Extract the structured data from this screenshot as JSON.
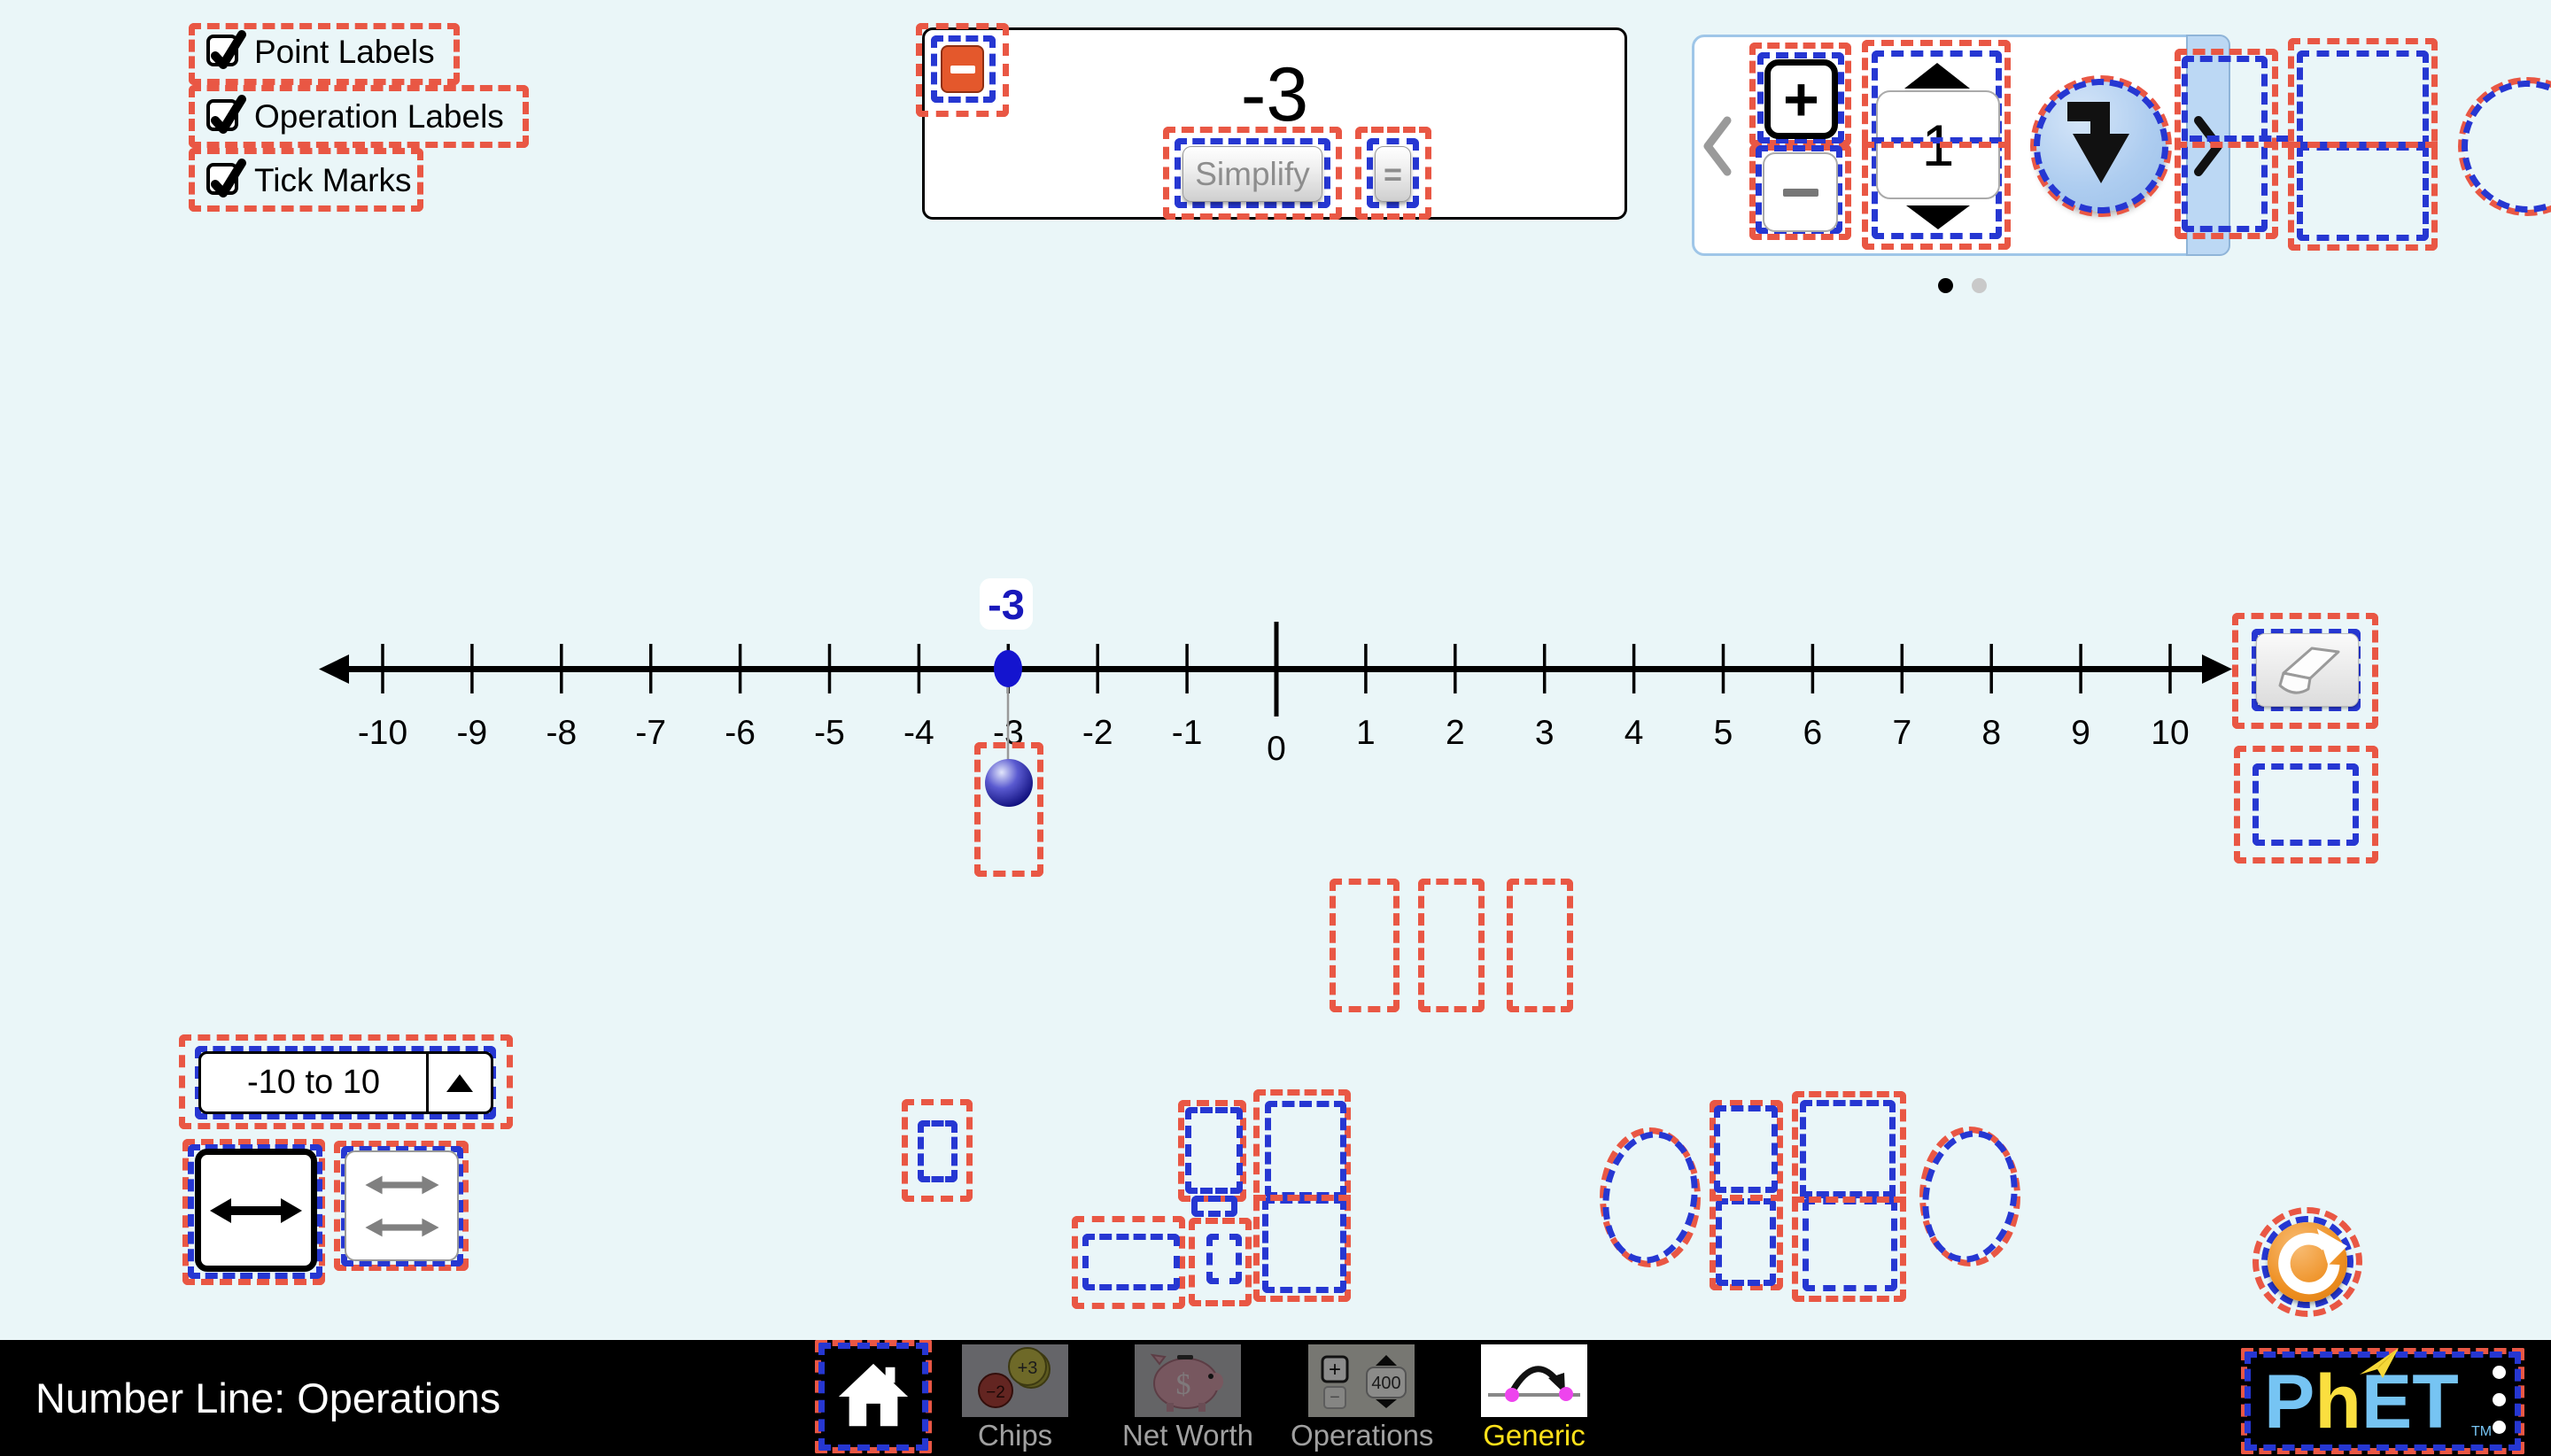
{
  "view_options": {
    "point_labels": "Point Labels",
    "operation_labels": "Operation Labels",
    "tick_marks": "Tick Marks"
  },
  "expression_panel": {
    "value": "-3",
    "simplify_label": "Simplify",
    "equals_label": "="
  },
  "carousel": {
    "plus_label": "+",
    "spinner_value": "1",
    "pages": 2,
    "current_page": 1
  },
  "number_line": {
    "range_min": -10,
    "range_max": 10,
    "tick_labels": [
      "-10",
      "-9",
      "-8",
      "-7",
      "-6",
      "-5",
      "-4",
      "-3",
      "-2",
      "-1",
      "0",
      "1",
      "2",
      "3",
      "4",
      "5",
      "6",
      "7",
      "8",
      "9",
      "10"
    ],
    "point_value": -3,
    "point_label": "-3"
  },
  "range_selector": {
    "value": "-10 to 10"
  },
  "navbar": {
    "title": "Number Line: Operations",
    "screens": [
      {
        "label": "Chips"
      },
      {
        "label": "Net Worth"
      },
      {
        "label": "Operations",
        "thumb_value": "400"
      },
      {
        "label": "Generic",
        "selected": true
      }
    ],
    "logo_text": "PhET",
    "logo_p": "P",
    "logo_h": "h",
    "logo_e": "E",
    "logo_t": "T",
    "tm": "TM"
  },
  "chips_thumb": {
    "red_chip": "-2",
    "yellow_chip": "+3"
  },
  "colors": {
    "background": "#eaf6f8",
    "annotation_red": "#e95744",
    "annotation_blue": "#2637d2",
    "point_blue": "#1414cf",
    "label_blue": "#1818bb",
    "remove_button_orange": "#e4582c",
    "reset_orange": "#ee8f21",
    "selected_screen_label": "#ffe11a",
    "carousel_strip": "#bcd8f4"
  }
}
